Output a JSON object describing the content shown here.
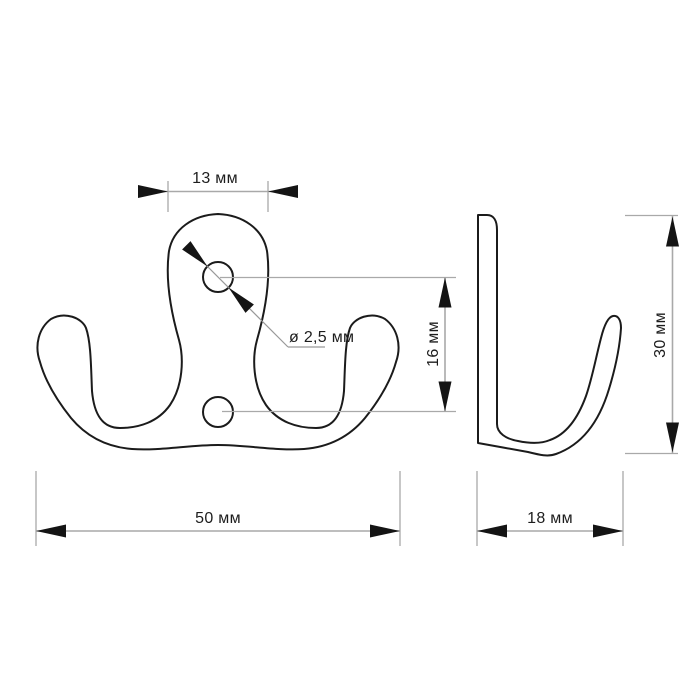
{
  "drawing": {
    "background_color": "#ffffff",
    "outline_color": "#1b1b1b",
    "dimension_line_color": "#a9a9a9",
    "arrow_color": "#141414",
    "label_color": "#1d1d1d",
    "dimensions": {
      "plate_top_width": "13 мм",
      "hole_diameter": "ø 2,5 мм",
      "hole_spacing": "16 мм",
      "overall_width": "50 мм",
      "side_depth": "18 мм",
      "side_height": "30 мм"
    }
  }
}
